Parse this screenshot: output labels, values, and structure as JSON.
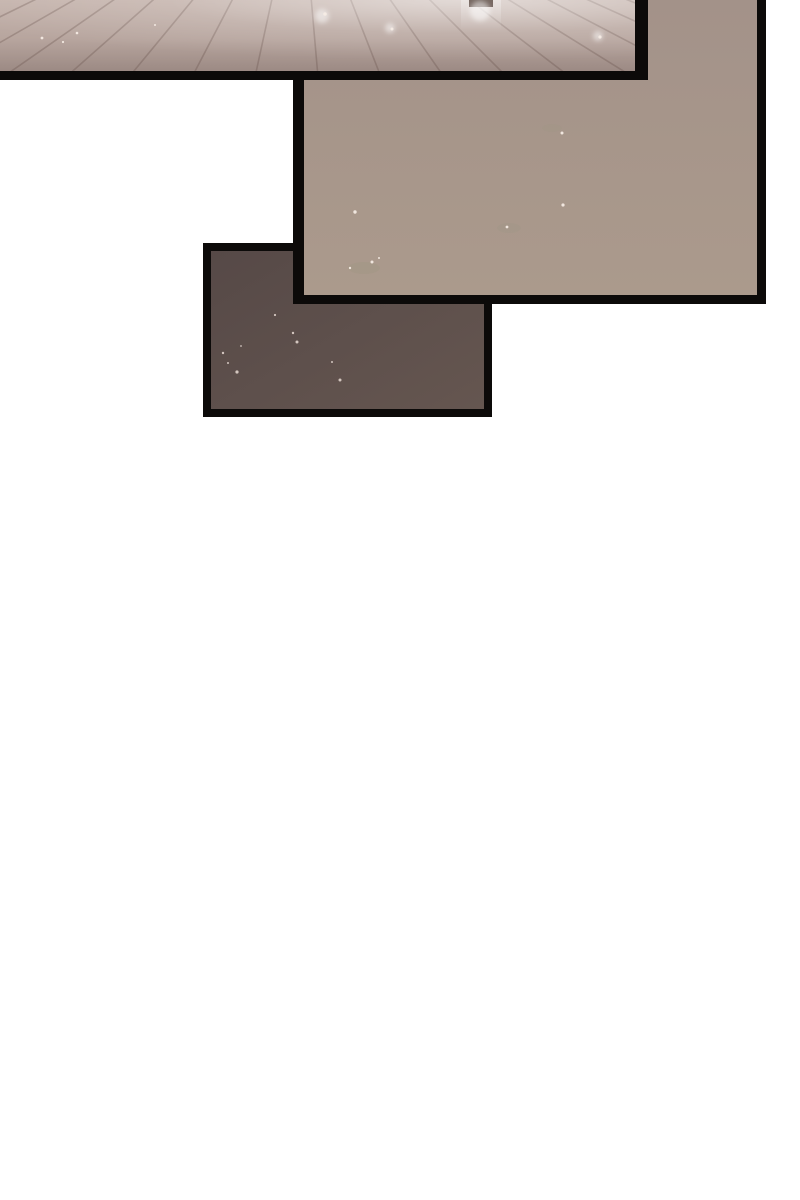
{
  "page": {
    "kind": "webtoon comic strip segment",
    "background_color": "#ffffff",
    "ink_color": "#0c0a09"
  },
  "panels": [
    {
      "name": "floor-panel",
      "description": "Wide top panel cropped by the page edge: pale hazy plank floor receding toward a vanishing point, with soft light glows, tiny motes and a bright vertical streak with a dark cap near the top",
      "colors": {
        "top": "#c6b5ae",
        "mid": "#b7a59e",
        "bottom": "#9c8a84",
        "line": "#66504a",
        "pillar_cap": "#6a5b54"
      },
      "floor_lines": {
        "vp": [
          300,
          -130
        ],
        "bottom_y": 100,
        "bottom_xs": [
          -240,
          -170,
          -100,
          -30,
          40,
          110,
          180,
          250,
          320,
          390,
          460,
          530,
          600,
          670,
          740,
          810,
          880
        ]
      },
      "glows": [
        [
          322,
          16,
          7
        ],
        [
          480,
          11,
          10
        ],
        [
          598,
          36,
          5
        ],
        [
          390,
          28,
          5
        ]
      ],
      "sparkles": [
        [
          42,
          38,
          1.4
        ],
        [
          63,
          42,
          1.1
        ],
        [
          77,
          33,
          1.3
        ],
        [
          155,
          25,
          1.0
        ],
        [
          325,
          14,
          1.8
        ],
        [
          392,
          29,
          1.5
        ],
        [
          600,
          37,
          1.6
        ]
      ]
    },
    {
      "name": "wall-panel",
      "description": "Tall panel open at the top: flat hazy taupe surface with tiny drifting motes and very faint mossy smudges near its lower left",
      "colors": {
        "top": "#a39289",
        "bottom": "#ab9a8c"
      },
      "sparkles": [
        [
          258,
          133,
          1.5
        ],
        [
          259,
          205,
          1.6
        ],
        [
          203,
          227,
          1.4
        ],
        [
          51,
          212,
          1.7
        ],
        [
          68,
          262,
          1.5
        ],
        [
          46,
          268,
          1.2
        ],
        [
          75,
          258,
          1.0
        ]
      ]
    },
    {
      "name": "dark-panel",
      "description": "Small lower-left panel layered behind the wall panel: dark dusky brown surface speckled with tiny points of light",
      "colors": {
        "top": "#564947",
        "bottom": "#655650"
      },
      "sparkles": [
        [
          86,
          91,
          1.5
        ],
        [
          26,
          121,
          1.6
        ],
        [
          12,
          102,
          1.2
        ],
        [
          17,
          112,
          1.0
        ],
        [
          82,
          82,
          1.2
        ],
        [
          64,
          64,
          1.1
        ],
        [
          129,
          129,
          1.5
        ],
        [
          121,
          111,
          1.0
        ],
        [
          30,
          95,
          0.9
        ]
      ]
    }
  ]
}
